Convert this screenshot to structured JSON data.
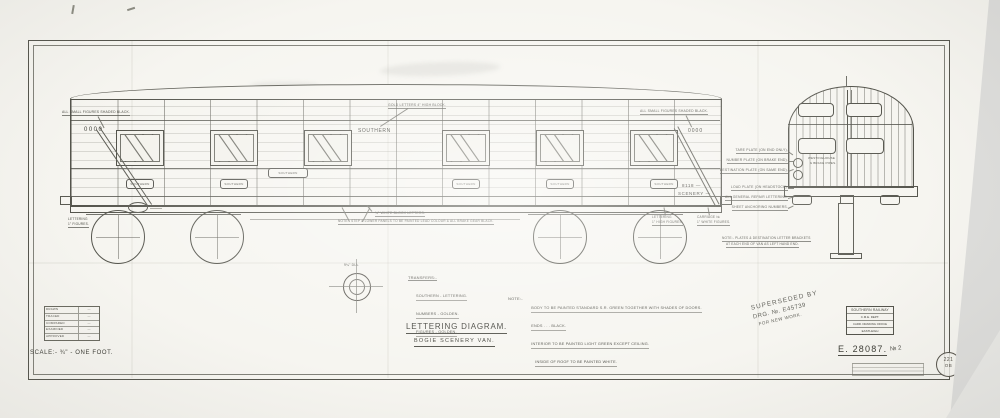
{
  "drawing": {
    "title": "LETTERING  DIAGRAM.",
    "subtitle": "BOGIE  SCENERY  VAN.",
    "scale": "SCALE:-  ¾\" - ONE FOOT.",
    "number": "E. 28087.",
    "number_suffix": "№ 2"
  },
  "van": {
    "brand": "SOUTHERN",
    "figures_left": "0000",
    "figures_right": "0000",
    "wagon_number": "8118 —",
    "class_word": "SCENERY —",
    "plate_text": "SOUTHERN"
  },
  "transfers": {
    "heading": "TRANSFERS:-",
    "lines": [
      "SOUTHERN - LETTERING.",
      "NUMBERS - GOLDEN.",
      "FIGURES - GOLDEN."
    ]
  },
  "note": {
    "heading": "NOTE:-",
    "lines": [
      "BODY TO BE PAINTED STANDARD S.R. GREEN TOGETHER WITH SHADES OF DOORS.",
      "ENDS  .  .  .  BLACK.",
      "INTERIOR TO BE PAINTED LIGHT GREEN EXCEPT CEILING.",
      "INSIDE OF ROOF TO BE PAINTED WHITE."
    ]
  },
  "annotations": {
    "small_figures_left": "ALL SMALL FIGURES SHADED BLACK.",
    "small_figures_right": "ALL SMALL FIGURES SHADED BLACK.",
    "gold_letters": "GOLD LETTERS 4\" HIGH BLOCK.",
    "white_block": "¾\" WHITE BLOCK LETTERS.",
    "step_note": "NOTE:- STEP & LOWER PANELS TO BE PAINTED LEAD COLOUR & ALL BRAKE GEAR BLACK.",
    "dia": "9¼\" DIA.",
    "lettering_a1": "LETTERING",
    "lettering_a2": "1\" HIGH FIGURES.",
    "lettering_b1": "CARRIAGE №",
    "lettering_b2": "1\" WHITE FIGURES.",
    "lettering_c1": "LETTERING",
    "lettering_c2": "1\" FIGURES.",
    "stack": [
      "TARE PLATE (ON END ONLY).",
      "NUMBER PLATE (ON BRAKE END).",
      "DESTINATION PLATE (ON SAME END).",
      "LOAD PLATE (ON HEADSTOCK).",
      "ALL GENERAL REPAIR LETTERING.",
      "SHEET ANCHORING NUMBERS."
    ],
    "westinghouse1": "WESTINGHOUSE",
    "westinghouse2": "& BRAKE PIPES.",
    "end_note1": "NOTE:- PLATES & DESTINATION LETTER BRACKETS",
    "end_note2": "AT EACH END OF VAN AS LEFT HAND END."
  },
  "rev_table": {
    "rows": [
      {
        "label": "DRAWN",
        "value": "—"
      },
      {
        "label": "TRACED",
        "value": "—"
      },
      {
        "label": "COMPARED",
        "value": "—"
      },
      {
        "label": "EXAMINED",
        "value": "—"
      },
      {
        "label": "APPROVED",
        "value": "—"
      }
    ]
  },
  "stamps": {
    "superseded": {
      "line1": "SUPERSEDED BY",
      "line2": "DRG. №. E45739",
      "line3": "FOR NEW WORK."
    },
    "office": {
      "line1": "SOUTHERN RAILWAY",
      "line2": "C.M.E. DEPT.",
      "line3": "CARR. DRAWING OFFICE",
      "line4": "EASTLEIGH"
    },
    "circle": {
      "top": "221",
      "bottom": "OB"
    }
  },
  "colors": {
    "paper": "#f6f5f0",
    "ink": "#4a4a44",
    "background_grey": "#dededc"
  }
}
